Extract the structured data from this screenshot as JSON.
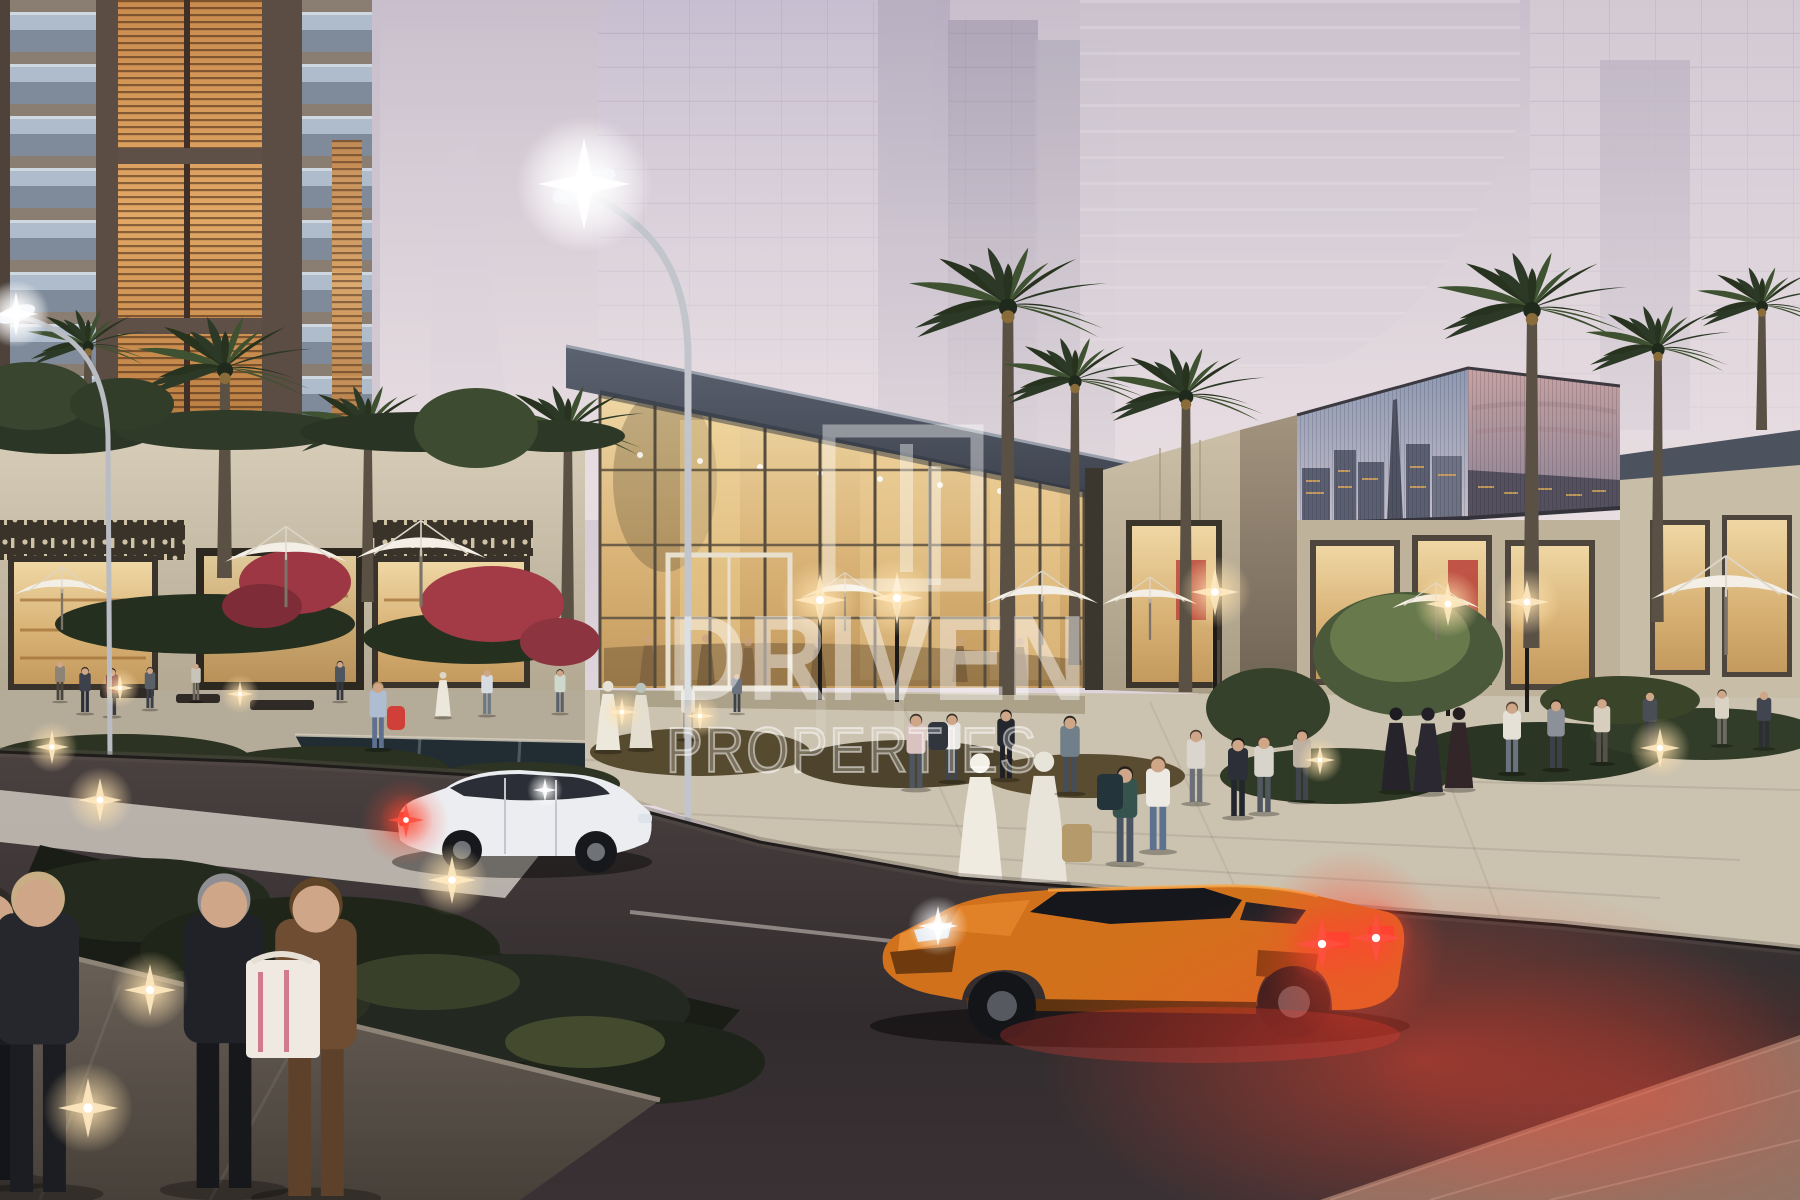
{
  "watermark": {
    "brand": "DRIVEN",
    "brand_sub": "PROPERTIES"
  },
  "palette": {
    "sky_top": "#c8bfcc",
    "sky_mid": "#d7cdd6",
    "sky_horizon": "#ece1e4",
    "haze": "#c5bdcb",
    "residential_amber": "#cf9254",
    "stone": "#cfc5b0",
    "glass_warm": "#e7c78e",
    "roof_gray": "#4a5160",
    "palm_green": "#2f3d2a",
    "plaza": "#cbc2af",
    "road": "#3f3739",
    "car_white": "#ecedf0",
    "lambo_orange": "#d2711c",
    "taillight_red": "#ff3b2e",
    "glow_red": "#ff4630",
    "watermark_white": "#ffffff"
  },
  "scene": {
    "palms": [
      {
        "x": 225,
        "y": 368,
        "s": 1.15,
        "t": 578
      },
      {
        "x": 368,
        "y": 428,
        "s": 0.95,
        "t": 602
      },
      {
        "x": 568,
        "y": 430,
        "s": 1.0,
        "t": 628
      },
      {
        "x": 1008,
        "y": 305,
        "s": 1.3,
        "t": 695
      },
      {
        "x": 1075,
        "y": 380,
        "s": 0.95,
        "t": 665
      },
      {
        "x": 1186,
        "y": 395,
        "s": 1.05,
        "t": 692
      },
      {
        "x": 1532,
        "y": 308,
        "s": 1.25,
        "t": 648
      },
      {
        "x": 1658,
        "y": 348,
        "s": 0.95,
        "t": 622
      },
      {
        "x": 88,
        "y": 345,
        "s": 0.8,
        "t": 425
      },
      {
        "x": 1762,
        "y": 305,
        "s": 0.85,
        "t": 430
      }
    ],
    "umbrellas": [
      {
        "x": 62,
        "y": 590,
        "w": 95
      },
      {
        "x": 286,
        "y": 556,
        "w": 122
      },
      {
        "x": 421,
        "y": 552,
        "w": 130
      },
      {
        "x": 845,
        "y": 594,
        "w": 88
      },
      {
        "x": 1042,
        "y": 598,
        "w": 112
      },
      {
        "x": 1150,
        "y": 600,
        "w": 95
      },
      {
        "x": 1436,
        "y": 604,
        "w": 88
      },
      {
        "x": 1726,
        "y": 592,
        "w": 150
      }
    ],
    "people": [
      {
        "x": 85,
        "y": 712,
        "h": 46,
        "top": "#3c414c",
        "bottom": "#2b2f37",
        "hair": "#23211e"
      },
      {
        "x": 112,
        "y": 715,
        "h": 48,
        "top": "#7d3e44",
        "bottom": "#383c46",
        "hair": "#1d1c1a"
      },
      {
        "x": 150,
        "y": 708,
        "h": 42,
        "top": "#596068",
        "bottom": "#3b3f48",
        "hair": "#2a2620"
      },
      {
        "x": 196,
        "y": 700,
        "h": 38,
        "top": "#c9c4b8",
        "bottom": "#6e6a60"
      },
      {
        "x": 340,
        "y": 700,
        "h": 40,
        "top": "#4e555e",
        "bottom": "#33373e",
        "hair": "#1f1e1b"
      },
      {
        "x": 378,
        "y": 748,
        "h": 68,
        "top": "#aebdd2",
        "bottom": "#5e7090",
        "hair": "#b08d5f",
        "bag": {
          "dx": 9,
          "dy": -42,
          "w": 18,
          "h": 24,
          "c": "#d04038"
        }
      },
      {
        "x": 443,
        "y": 716,
        "h": 46,
        "robe": "#ece7db",
        "head": "#dad6c8"
      },
      {
        "x": 487,
        "y": 714,
        "h": 46,
        "top": "#d7dce2",
        "bottom": "#6f7986"
      },
      {
        "x": 560,
        "y": 712,
        "h": 44,
        "top": "#cfd8cc",
        "bottom": "#5a6069",
        "hair": "#3a332a"
      },
      {
        "x": 608,
        "y": 750,
        "h": 72,
        "robe": "#ece8dc",
        "head": "#e6e2d6"
      },
      {
        "x": 641,
        "y": 748,
        "h": 68,
        "robe": "#e4ded0",
        "head": "#b9c4bf"
      },
      {
        "x": 688,
        "y": 738,
        "h": 56,
        "top": "#e2ded2",
        "bottom": "#8b8578",
        "hair": "#5c4a38"
      },
      {
        "x": 737,
        "y": 712,
        "h": 40,
        "top": "#6b7280",
        "bottom": "#3e434b"
      },
      {
        "x": 916,
        "y": 788,
        "h": 76,
        "top": "#d9c2bf",
        "bottom": "#4e5662",
        "hair": "#3c332c"
      },
      {
        "x": 952,
        "y": 780,
        "h": 68,
        "top": "#e9e7e3",
        "bottom": "#3f4650",
        "hair": "#2e2a24",
        "bag": {
          "dx": -24,
          "dy": -58,
          "w": 20,
          "h": 28,
          "c": "#31353d"
        }
      },
      {
        "x": 1006,
        "y": 778,
        "h": 70,
        "top": "#24272d",
        "bottom": "#1d2026",
        "hair": "#191715"
      },
      {
        "x": 980,
        "y": 880,
        "h": 132,
        "robe": "#f0ebe1",
        "head": "#f3f0e7"
      },
      {
        "x": 1044,
        "y": 882,
        "h": 136,
        "robe": "#e9e4da",
        "head": "#e7e4da",
        "bag": {
          "dx": 18,
          "dy": -58,
          "w": 30,
          "h": 38,
          "c": "#b59a6c"
        }
      },
      {
        "x": 1070,
        "y": 792,
        "h": 78,
        "top": "#707f8a",
        "bottom": "#454d58",
        "hair": "#27241f"
      },
      {
        "x": 1125,
        "y": 862,
        "h": 98,
        "top": "#37534d",
        "bottom": "#4a5462",
        "hair": "#23201c",
        "bag": {
          "dx": -28,
          "dy": -88,
          "w": 26,
          "h": 36,
          "c": "#23343a"
        }
      },
      {
        "x": 1158,
        "y": 850,
        "h": 96,
        "top": "#edeae4",
        "bottom": "#5d7191",
        "hair": "#64492f"
      },
      {
        "x": 1196,
        "y": 802,
        "h": 74,
        "top": "#dad6cd",
        "bottom": "#6a6f78",
        "hair": "#4a3c30"
      },
      {
        "x": 1238,
        "y": 816,
        "h": 80,
        "top": "#2c2f37",
        "bottom": "#23262c",
        "hair": "#1b1917"
      },
      {
        "x": 1264,
        "y": 812,
        "h": 78,
        "top": "#d8d4cb",
        "bottom": "#505760",
        "hair": "#3f362c"
      },
      {
        "x": 1302,
        "y": 800,
        "h": 72,
        "top": "#bbb0a2",
        "bottom": "#40454e",
        "hair": "#2c2620"
      },
      {
        "x": 1396,
        "y": 790,
        "h": 86,
        "robe": "#26242a",
        "head": "#1d1b21"
      },
      {
        "x": 1428,
        "y": 792,
        "h": 88,
        "robe": "#2b2831",
        "head": "#221f27"
      },
      {
        "x": 1459,
        "y": 788,
        "h": 84,
        "robe": "#322629",
        "head": "#251c1f"
      },
      {
        "x": 1512,
        "y": 772,
        "h": 72,
        "top": "#e5e1d7",
        "bottom": "#6b7382",
        "hair": "#55432f"
      },
      {
        "x": 1556,
        "y": 768,
        "h": 70,
        "top": "#8b9099",
        "bottom": "#3c4149",
        "hair": "#2b2824"
      },
      {
        "x": 1602,
        "y": 762,
        "h": 66,
        "top": "#d8cebe",
        "bottom": "#56514b",
        "hair": "#3e362c"
      },
      {
        "x": 1650,
        "y": 748,
        "h": 58,
        "top": "#484d56",
        "bottom": "#30343b"
      },
      {
        "x": 1722,
        "y": 744,
        "h": 56,
        "top": "#dad3c5",
        "bottom": "#6f6b63",
        "hair": "#4d4438"
      },
      {
        "x": 1764,
        "y": 747,
        "h": 58,
        "top": "#40454f",
        "bottom": "#2b2e34"
      },
      {
        "x": 60,
        "y": 700,
        "h": 40,
        "top": "#8b8477",
        "bottom": "#4a463e"
      }
    ],
    "people_inside": [
      {
        "x": 648,
        "y": 686,
        "h": 52,
        "robe": "#7a5f3e"
      },
      {
        "x": 706,
        "y": 688,
        "h": 56,
        "robe": "#6f5636"
      },
      {
        "x": 748,
        "y": 690,
        "h": 54,
        "robe": "#7a5f3e"
      },
      {
        "x": 818,
        "y": 688,
        "h": 50,
        "robe": "#6f5636"
      },
      {
        "x": 1020,
        "y": 686,
        "h": 50,
        "robe": "#7a5f3e"
      },
      {
        "x": 960,
        "y": 682,
        "h": 46,
        "robe": "#6f5636"
      }
    ],
    "people_foreground": [
      {
        "x": -8,
        "y": 1180,
        "h": 300,
        "top": "#1b1c20",
        "bottom": "#141518",
        "hair": "#2e2a26"
      },
      {
        "x": 38,
        "y": 1192,
        "h": 328,
        "top": "#26272d",
        "bottom": "#1c1d22",
        "hair": "#c8ae85"
      },
      {
        "x": 224,
        "y": 1188,
        "h": 322,
        "top": "#202228",
        "bottom": "#16181c",
        "hair": "#8f8f93"
      },
      {
        "x": 316,
        "y": 1196,
        "h": 326,
        "top": "#6f4d32",
        "bottom": "#5e412a",
        "hair": "#5f4327",
        "bag": {
          "dx": -70,
          "dy": -236,
          "w": 74,
          "h": 98,
          "c": "#efe9e2"
        }
      }
    ],
    "greenery_upper": [
      {
        "x": 60,
        "y": 432,
        "rx": 95,
        "ry": 22,
        "c": "#2c3626"
      },
      {
        "x": 230,
        "y": 430,
        "rx": 115,
        "ry": 20,
        "c": "#2f3a28"
      },
      {
        "x": 420,
        "y": 432,
        "rx": 120,
        "ry": 20,
        "c": "#2a3424"
      },
      {
        "x": 555,
        "y": 436,
        "rx": 70,
        "ry": 16,
        "c": "#2e3827"
      },
      {
        "x": 30,
        "y": 396,
        "rx": 62,
        "ry": 34,
        "c": "#39452e"
      },
      {
        "x": 122,
        "y": 404,
        "rx": 52,
        "ry": 26,
        "c": "#323d29"
      },
      {
        "x": 476,
        "y": 428,
        "rx": 62,
        "ry": 40,
        "c": "#3d4b31"
      },
      {
        "x": 205,
        "y": 624,
        "rx": 150,
        "ry": 30,
        "c": "#252f1f"
      },
      {
        "x": 475,
        "y": 638,
        "rx": 112,
        "ry": 26,
        "c": "#26301f"
      },
      {
        "x": 295,
        "y": 582,
        "rx": 56,
        "ry": 32,
        "c": "#9c3743"
      },
      {
        "x": 262,
        "y": 606,
        "rx": 40,
        "ry": 22,
        "c": "#7e2d38"
      },
      {
        "x": 492,
        "y": 604,
        "rx": 72,
        "ry": 38,
        "c": "#a23b45"
      },
      {
        "x": 560,
        "y": 642,
        "rx": 40,
        "ry": 24,
        "c": "#8c3440"
      },
      {
        "x": 120,
        "y": 758,
        "rx": 130,
        "ry": 24,
        "c": "#2c3322"
      },
      {
        "x": 330,
        "y": 770,
        "rx": 120,
        "ry": 24,
        "c": "#2a3121"
      },
      {
        "x": 520,
        "y": 784,
        "rx": 100,
        "ry": 22,
        "c": "#2d3423"
      },
      {
        "x": 700,
        "y": 752,
        "rx": 110,
        "ry": 24,
        "c": "#564a2f"
      },
      {
        "x": 905,
        "y": 764,
        "rx": 110,
        "ry": 24,
        "c": "#4e432c"
      },
      {
        "x": 1085,
        "y": 776,
        "rx": 100,
        "ry": 22,
        "c": "#594c30"
      },
      {
        "x": 1335,
        "y": 776,
        "rx": 115,
        "ry": 28,
        "c": "#2f3a26"
      },
      {
        "x": 1540,
        "y": 752,
        "rx": 125,
        "ry": 30,
        "c": "#2b3523"
      },
      {
        "x": 1705,
        "y": 734,
        "rx": 115,
        "ry": 26,
        "c": "#323d29"
      },
      {
        "x": 1408,
        "y": 654,
        "rx": 95,
        "ry": 62,
        "c": "#49593a"
      },
      {
        "x": 1400,
        "y": 638,
        "rx": 70,
        "ry": 44,
        "c": "#687a4c"
      },
      {
        "x": 1268,
        "y": 708,
        "rx": 62,
        "ry": 40,
        "c": "#36412b"
      },
      {
        "x": 1620,
        "y": 700,
        "rx": 80,
        "ry": 24,
        "c": "#3a4429"
      }
    ],
    "greenery_lower": [
      {
        "x": 140,
        "y": 900,
        "rx": 130,
        "ry": 42,
        "c": "#242a1d"
      },
      {
        "x": 320,
        "y": 950,
        "rx": 180,
        "ry": 54,
        "c": "#1f2518"
      },
      {
        "x": 520,
        "y": 1008,
        "rx": 170,
        "ry": 54,
        "c": "#232920"
      },
      {
        "x": 645,
        "y": 1062,
        "rx": 120,
        "ry": 42,
        "c": "#1e2419"
      },
      {
        "x": 250,
        "y": 1002,
        "rx": 120,
        "ry": 38,
        "c": "#2a3122"
      },
      {
        "x": 430,
        "y": 982,
        "rx": 90,
        "ry": 28,
        "c": "#39402a"
      },
      {
        "x": 585,
        "y": 1042,
        "rx": 80,
        "ry": 26,
        "c": "#434a2e"
      }
    ],
    "glints": [
      {
        "x": 584,
        "y": 184,
        "s": 46,
        "k": "white"
      },
      {
        "x": 16,
        "y": 314,
        "s": 22,
        "k": "white"
      },
      {
        "x": 820,
        "y": 600,
        "s": 26,
        "k": "warm"
      },
      {
        "x": 897,
        "y": 598,
        "s": 26,
        "k": "warm"
      },
      {
        "x": 1215,
        "y": 592,
        "s": 24,
        "k": "warm"
      },
      {
        "x": 1448,
        "y": 604,
        "s": 22,
        "k": "warm"
      },
      {
        "x": 1527,
        "y": 602,
        "s": 22,
        "k": "warm"
      },
      {
        "x": 622,
        "y": 712,
        "s": 14,
        "k": "warm"
      },
      {
        "x": 700,
        "y": 716,
        "s": 14,
        "k": "warm"
      },
      {
        "x": 120,
        "y": 688,
        "s": 13,
        "k": "warm"
      },
      {
        "x": 240,
        "y": 694,
        "s": 13,
        "k": "warm"
      },
      {
        "x": 100,
        "y": 800,
        "s": 22,
        "k": "warm"
      },
      {
        "x": 52,
        "y": 747,
        "s": 17,
        "k": "warm"
      },
      {
        "x": 452,
        "y": 880,
        "s": 24,
        "k": "warm"
      },
      {
        "x": 150,
        "y": 990,
        "s": 26,
        "k": "warm"
      },
      {
        "x": 88,
        "y": 1108,
        "s": 30,
        "k": "warm"
      },
      {
        "x": 1660,
        "y": 748,
        "s": 20,
        "k": "warm"
      },
      {
        "x": 1320,
        "y": 760,
        "s": 15,
        "k": "warm"
      },
      {
        "x": 406,
        "y": 820,
        "s": 18,
        "k": "red"
      },
      {
        "x": 1322,
        "y": 944,
        "s": 26,
        "k": "red"
      },
      {
        "x": 1376,
        "y": 938,
        "s": 26,
        "k": "red"
      },
      {
        "x": 938,
        "y": 926,
        "s": 20,
        "k": "white"
      },
      {
        "x": 545,
        "y": 790,
        "s": 12,
        "k": "white"
      }
    ]
  }
}
